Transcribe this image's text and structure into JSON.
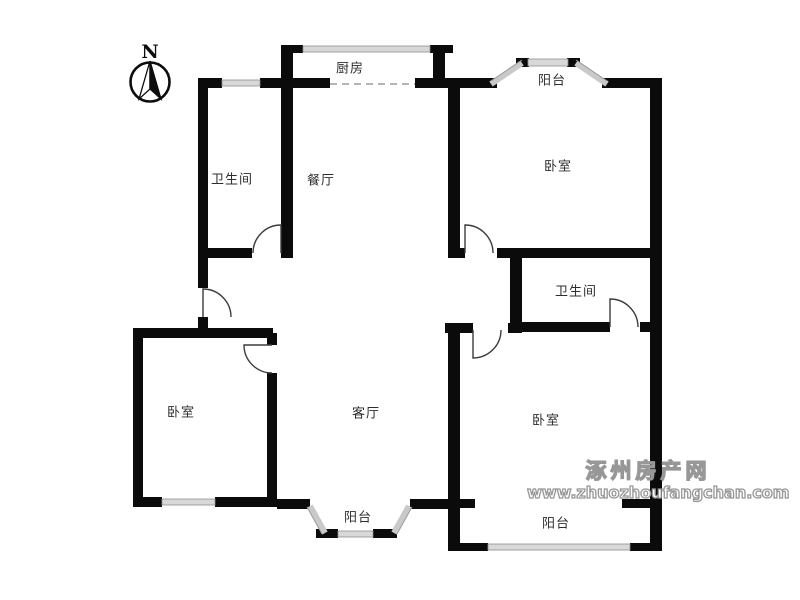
{
  "compass": {
    "label": "N"
  },
  "rooms": [
    {
      "name": "kitchen",
      "label": "厨房"
    },
    {
      "name": "balcony-north",
      "label": "阳台"
    },
    {
      "name": "bathroom-west",
      "label": "卫生间"
    },
    {
      "name": "dining-room",
      "label": "餐厅"
    },
    {
      "name": "bedroom-northeast",
      "label": "卧室"
    },
    {
      "name": "bathroom-east",
      "label": "卫生间"
    },
    {
      "name": "bedroom-west",
      "label": "卧室"
    },
    {
      "name": "living-room",
      "label": "客厅"
    },
    {
      "name": "bedroom-southeast",
      "label": "卧室"
    },
    {
      "name": "balcony-south",
      "label": "阳台"
    },
    {
      "name": "balcony-southeast",
      "label": "阳台"
    }
  ],
  "watermark": {
    "site_name": "涿州房产网",
    "site_url": "www.zhuozhoufangchan.com"
  },
  "colors": {
    "wall": "#0b0b0b",
    "window_fill": "#d8d8d8",
    "window_edge": "#8f8f8f",
    "door_arc": "#3c3c3c",
    "balcony_glass": "#c9c9c9",
    "label_text": "#2e2e2e",
    "watermark_outline": "#979797"
  }
}
